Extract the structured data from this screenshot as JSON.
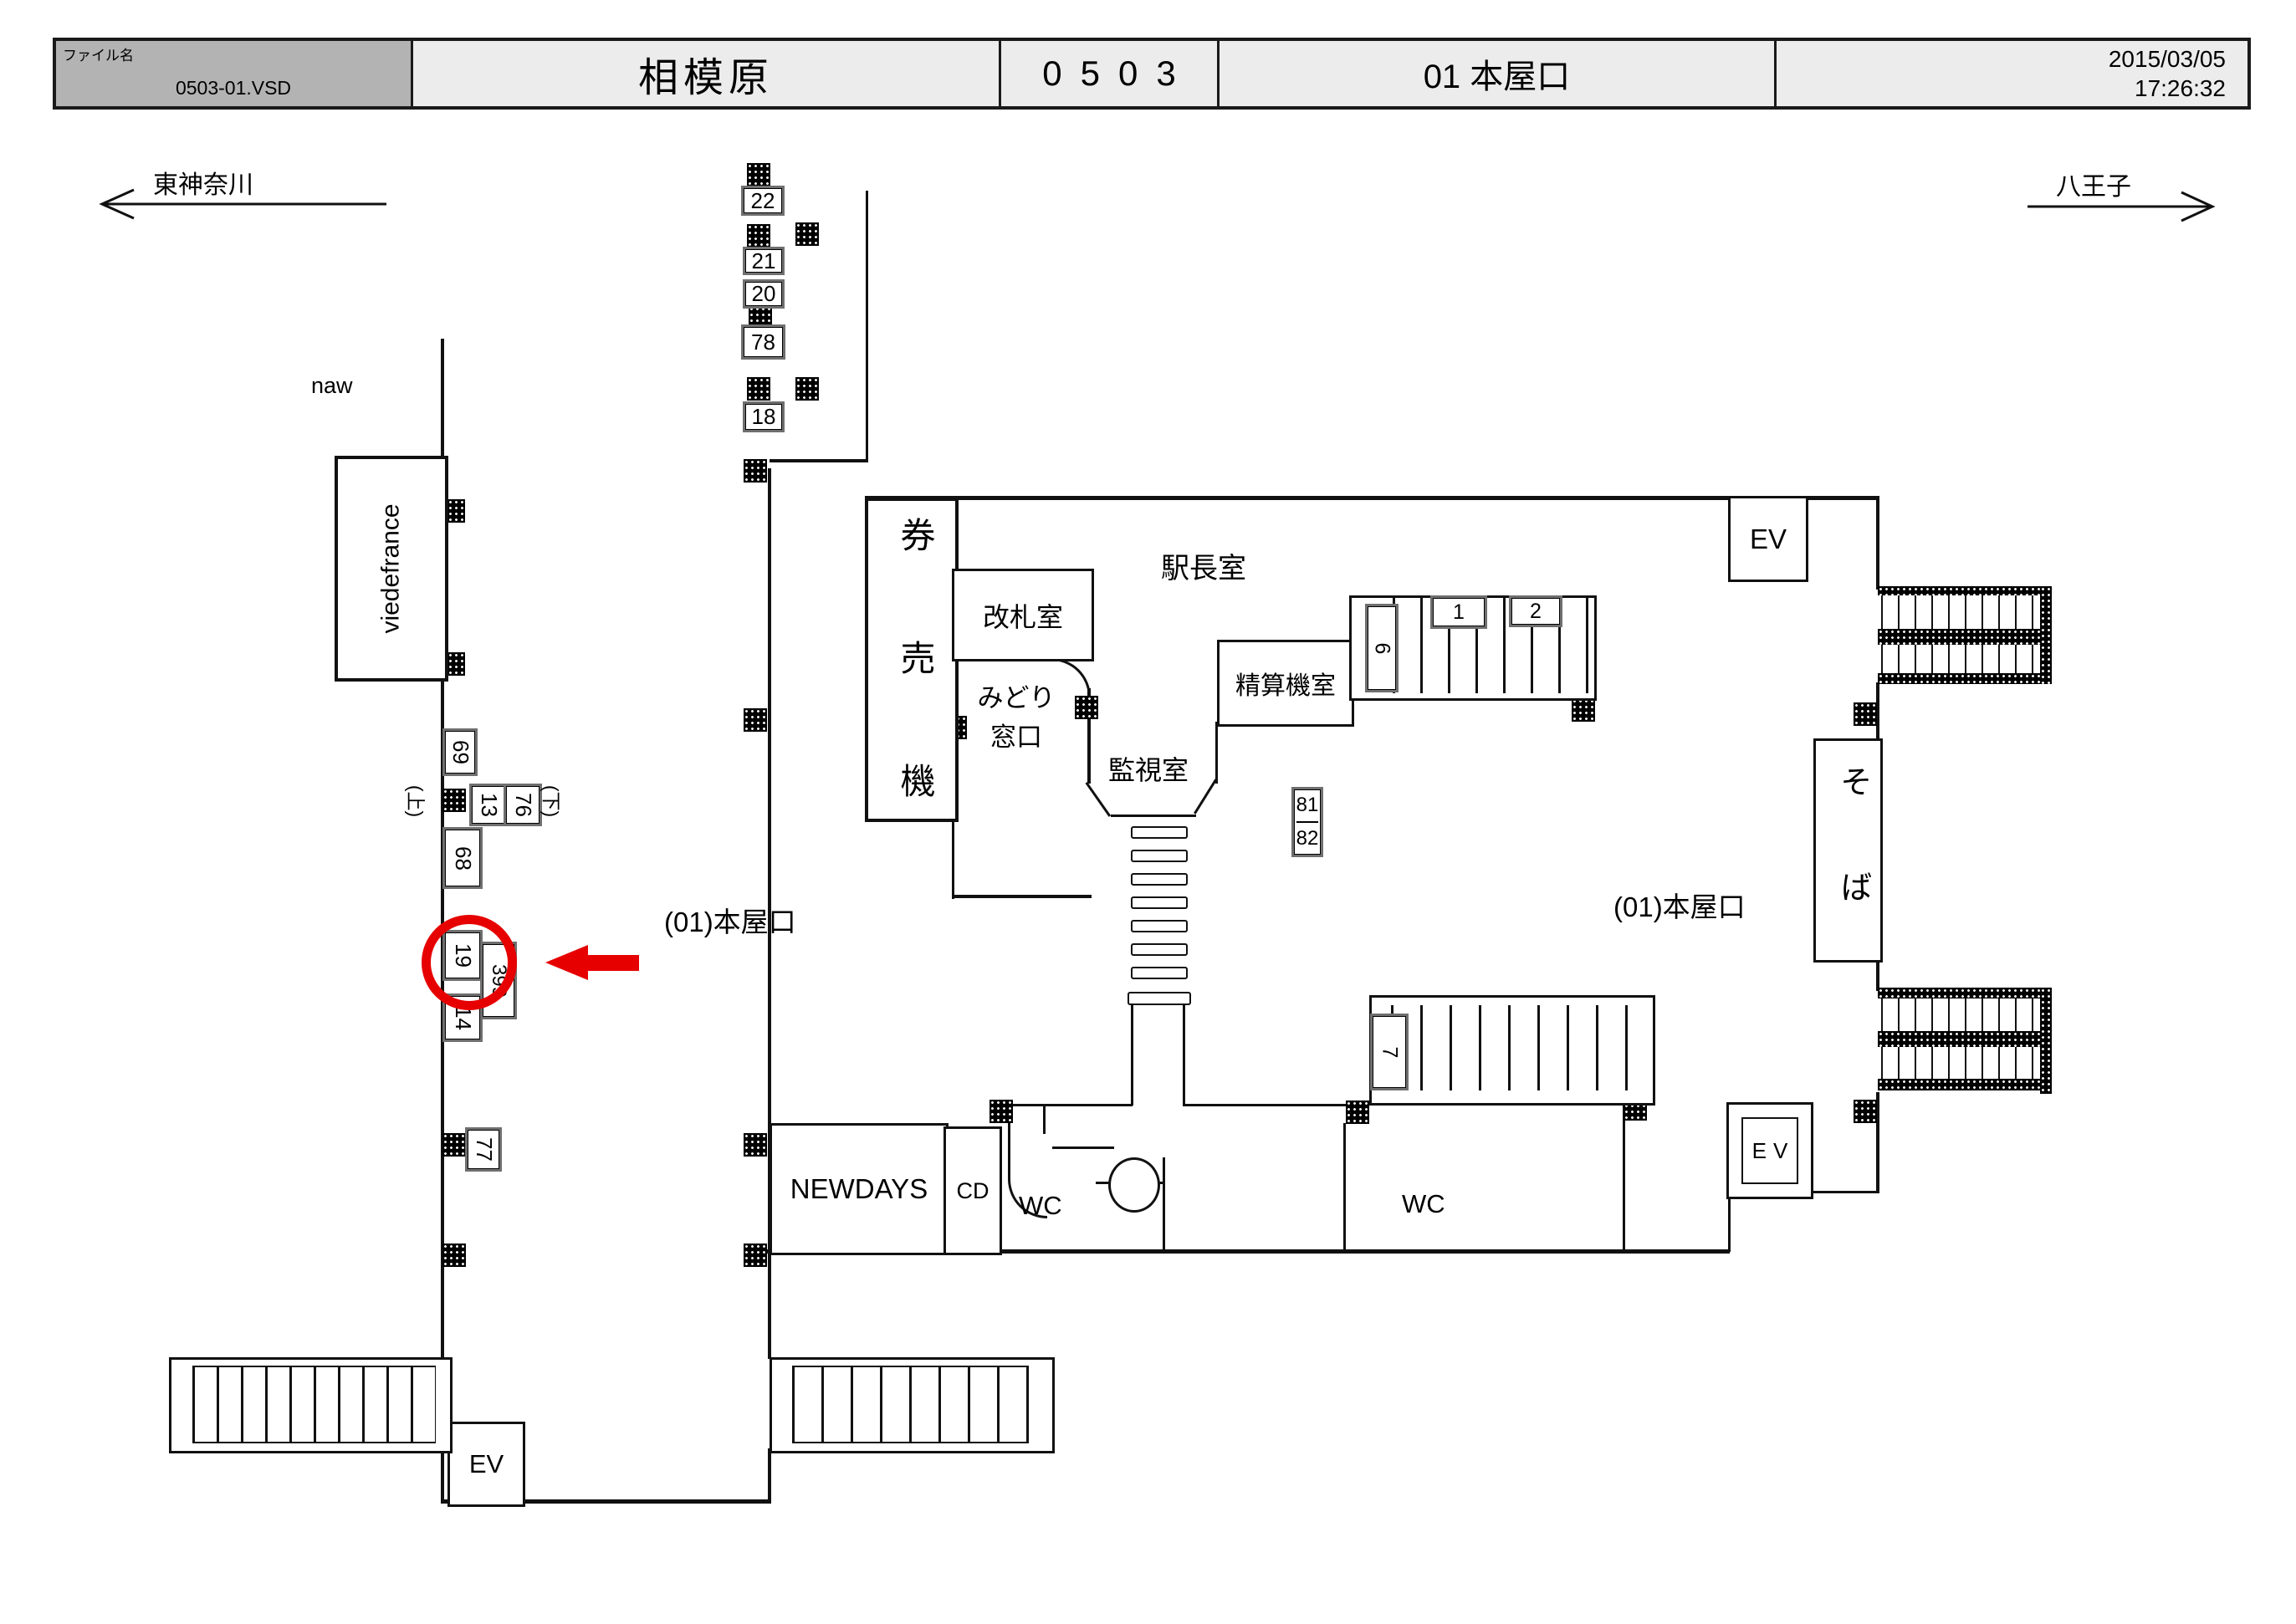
{
  "header": {
    "file_label": "ファイル名",
    "file_name": "0503-01.VSD",
    "station_name": "相模原",
    "station_code": "0503",
    "map_title": "01 本屋口",
    "date": "2015/03/05",
    "time": "17:26:32"
  },
  "directions": {
    "left": "東神奈川",
    "right": "八王子"
  },
  "exits": {
    "left": "(01)本屋口",
    "right": "(01)本屋口"
  },
  "rooms": {
    "ticket_machines": "券売機",
    "gate_office": "改札室",
    "midori": [
      "みどり",
      "窓口"
    ],
    "station_master": "駅長室",
    "fare_adjustment": "精算機室",
    "monitoring": "監視室",
    "wc_left": "WC",
    "wc_right": "WC"
  },
  "stores": {
    "naw": "naw",
    "viedefrance": "viedefrance",
    "newdays": "NEWDAYS",
    "cd": "CD",
    "soba": "そば"
  },
  "elevators": {
    "top_right": "EV",
    "bottom_right": "EV",
    "bottom_left": "EV"
  },
  "annotations": {
    "up": "(上)",
    "down": "(下)"
  },
  "ad_locations": {
    "n22": "22",
    "n21": "21",
    "n20": "20",
    "n78": "78",
    "n18": "18",
    "n69": "69",
    "n13": "13",
    "n76": "76",
    "n68": "68",
    "n19": "19",
    "n399": "399",
    "n14": "14",
    "n77": "77",
    "n81": "81",
    "n82": "82",
    "n6": "6",
    "n1": "1",
    "n2": "2",
    "n7": "7"
  },
  "highlight": {
    "target": "19",
    "color": "#e60000"
  }
}
